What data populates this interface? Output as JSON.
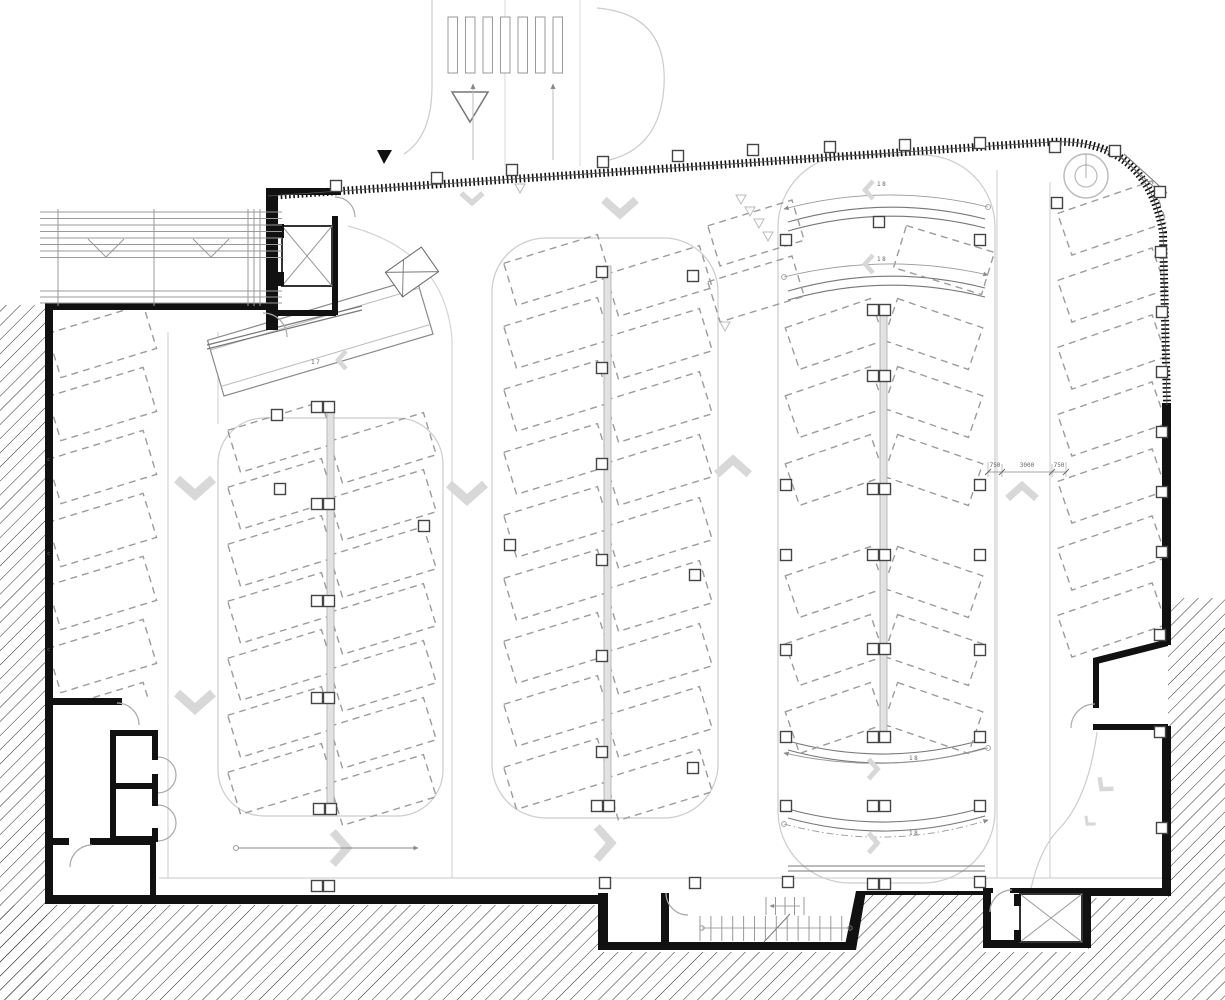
{
  "plan": {
    "ramp_labels": {
      "internal": "17",
      "upper_a": "18",
      "upper_b": "18",
      "lower_a": "18",
      "lower_b": "18"
    },
    "dimension": {
      "left": "750",
      "middle": "3000",
      "right": "750"
    },
    "wall_markers": [
      "c",
      "c",
      "c"
    ],
    "colors": {
      "wall": "#111111",
      "stall_dash": "#9c9c9c",
      "road_line": "#d4d4d4",
      "chevron": "#d8d8d8",
      "hatch": "#2a2a2a"
    }
  }
}
